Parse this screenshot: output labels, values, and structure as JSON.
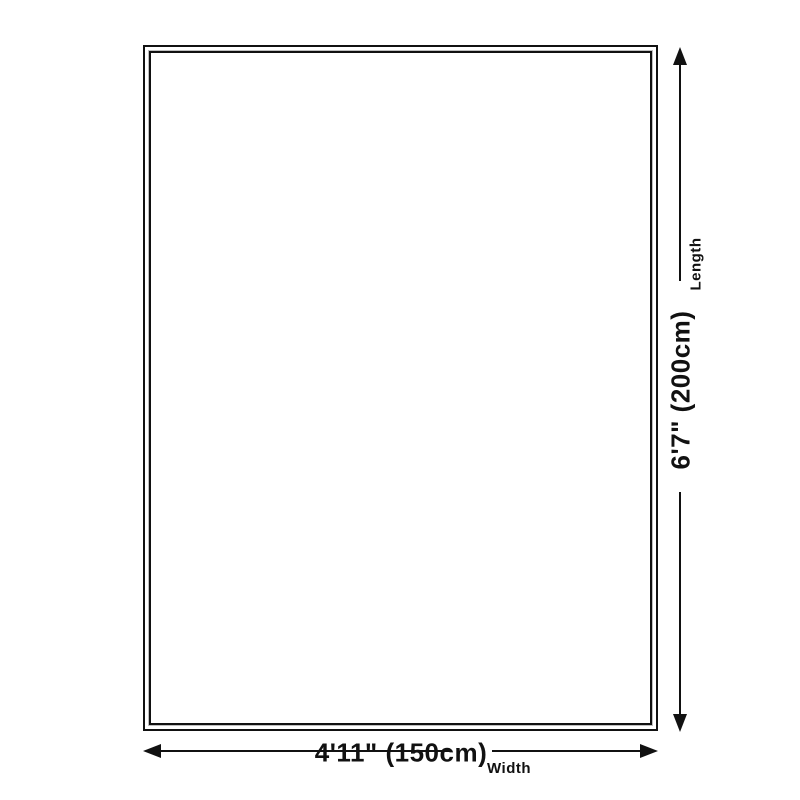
{
  "colors": {
    "line": "#111111",
    "background": "#ffffff",
    "inner_outline": "#bfbfbf"
  },
  "length_axis": {
    "dimension": "6'7\" (200cm)",
    "label": "Length"
  },
  "width_axis": {
    "dimension": "4'11\" (150cm)",
    "label": "Width"
  }
}
